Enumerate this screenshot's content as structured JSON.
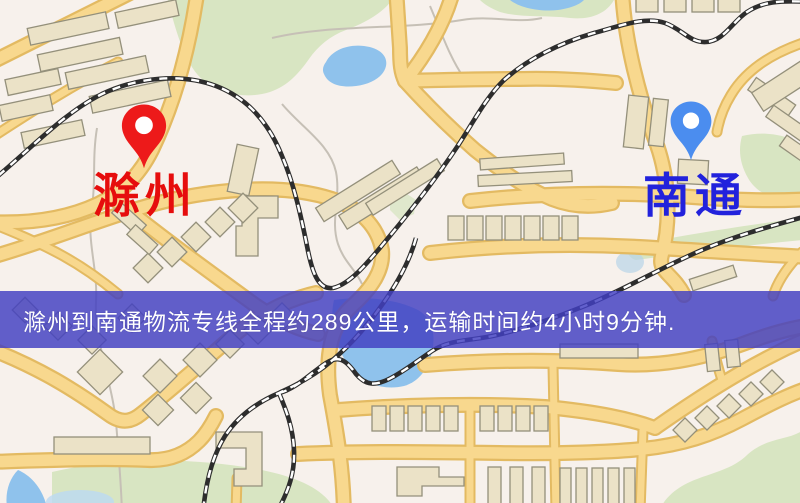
{
  "route_banner": {
    "text": "滁州到南通物流专线全程约289公里，运输时间约4小时9分钟.",
    "background_color": "#4240c2",
    "text_color": "#ffffff"
  },
  "markers": {
    "origin": {
      "label": "滁州",
      "label_color": "#e60d0d",
      "pin_color": "#ed1a1a"
    },
    "destination": {
      "label": "南通",
      "label_color": "#2222dc",
      "pin_color": "#4b8def"
    }
  },
  "route": {
    "origin": "滁州",
    "destination": "南通",
    "distance_text": "约289公里",
    "duration_text": "约4小时9分钟"
  },
  "map_palette": {
    "background": "#f7f1ec",
    "road_fill": "#f8d88e",
    "road_casing": "#e3ba62",
    "building": "#ebe2c7",
    "park": "#d8e5c2",
    "water": "#8fc2ec",
    "railway": "#2d2d2d"
  }
}
